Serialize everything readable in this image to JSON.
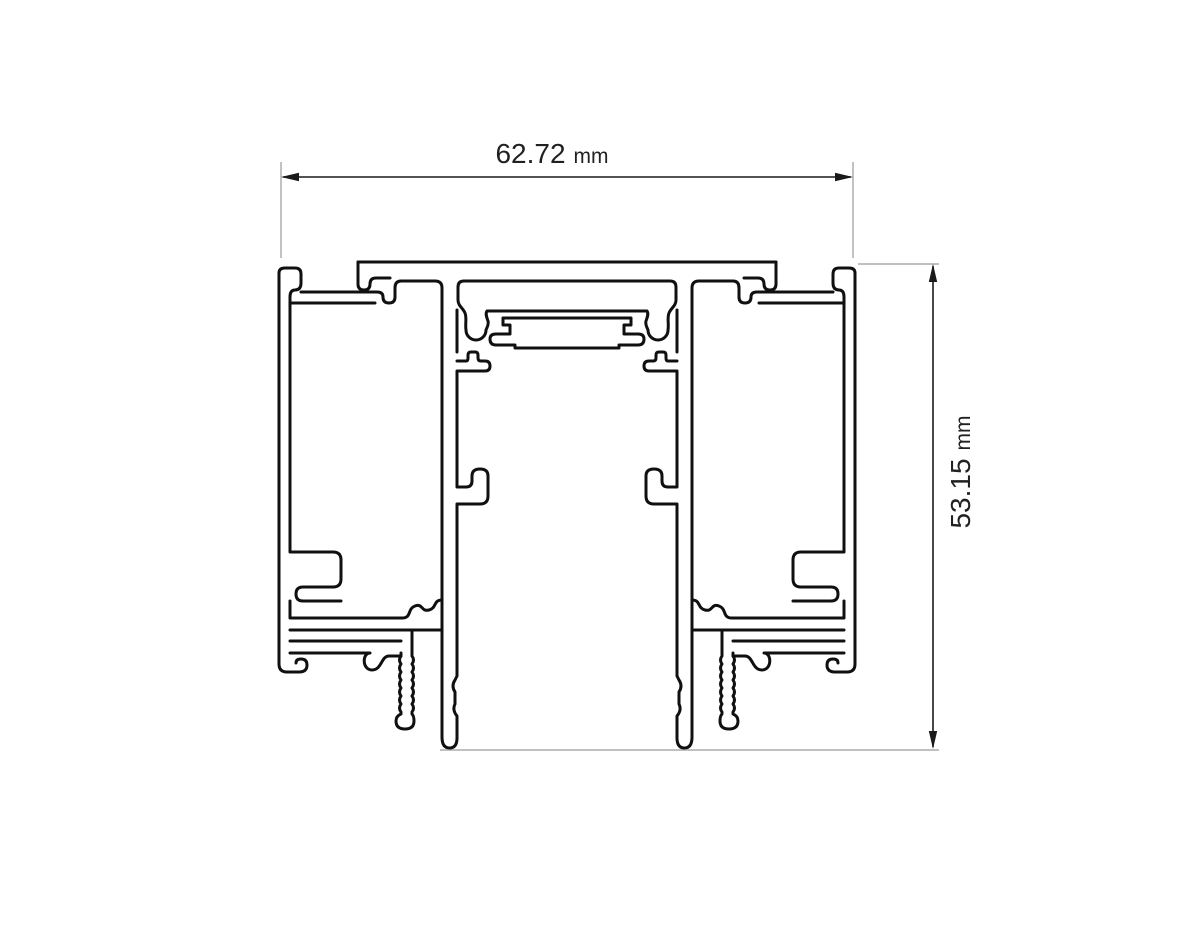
{
  "drawing": {
    "kind": "aluminium-profile-cross-section",
    "dimensions": {
      "width": {
        "value": "62.72",
        "unit": "mm"
      },
      "height": {
        "value": "53.15",
        "unit": "mm"
      }
    },
    "colors": {
      "background": "#ffffff",
      "line": "#101010",
      "dimension": "#1a1a1a",
      "extension": "#9a9a9a",
      "text": "#212121"
    }
  }
}
